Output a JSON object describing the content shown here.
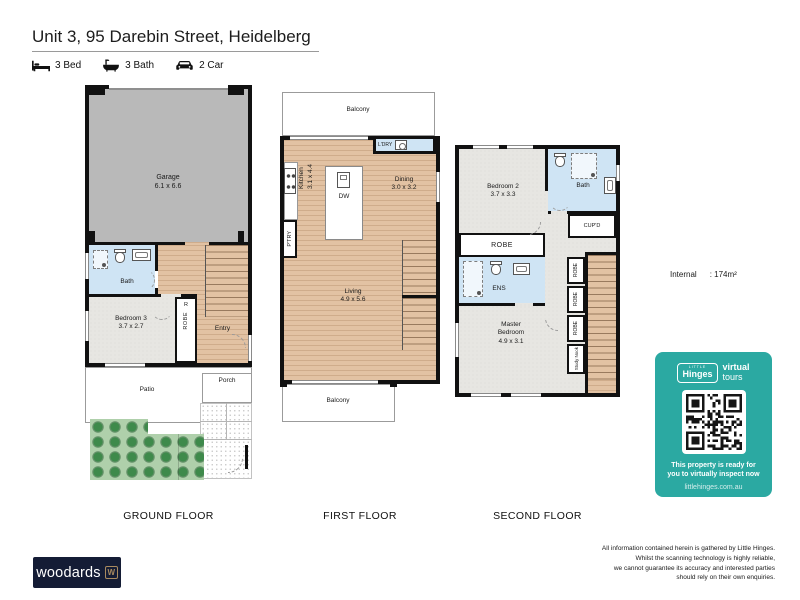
{
  "header": {
    "title": "Unit 3, 95 Darebin Street, Heidelberg",
    "features": [
      {
        "icon": "bed-icon",
        "label": "3 Bed"
      },
      {
        "icon": "bath-icon",
        "label": "3 Bath"
      },
      {
        "icon": "car-icon",
        "label": "2 Car"
      }
    ]
  },
  "floors": {
    "ground": {
      "caption": "GROUND FLOOR",
      "garage_name": "Garage",
      "garage_dims": "6.1 x 6.6",
      "bath_label": "Bath",
      "bedroom3_name": "Bedroom 3",
      "bedroom3_dims": "3.7 x 2.7",
      "robe_r": "R",
      "robe": "ROBE",
      "entry": "Entry",
      "patio": "Patio",
      "porch": "Porch"
    },
    "first": {
      "caption": "FIRST FLOOR",
      "balcony_top": "Balcony",
      "laundry": "L'DRY",
      "kitchen_name": "Kitchen",
      "kitchen_dims": "3.1 x 4.4",
      "pantry": "P'TRY",
      "dishwasher": "DW",
      "dining_name": "Dining",
      "dining_dims": "3.0 x 3.2",
      "living_name": "Living",
      "living_dims": "4.9 x 5.6",
      "balcony_bottom": "Balcony"
    },
    "second": {
      "caption": "SECOND FLOOR",
      "bedroom2_name": "Bedroom 2",
      "bedroom2_dims": "3.7 x 3.3",
      "bath_label": "Bath",
      "cupboard": "CUP'D",
      "robe_band": "ROBE",
      "ensuite": "ENS",
      "master_line1": "Master",
      "master_line2": "Bedroom",
      "master_dims": "4.9 x 3.1",
      "robes": [
        "ROBE",
        "ROBE",
        "ROBE"
      ],
      "study_nook": "Study Nook"
    }
  },
  "area": {
    "label": "Internal",
    "value": ": 174m²"
  },
  "virtual_tour_card": {
    "brand_small": "LITTLE",
    "brand_name": "Hinges",
    "brand_word1": "virtual",
    "brand_word2": "tours",
    "message_line1": "This property is ready for",
    "message_line2": "you to virtually inspect now",
    "website": "littlehinges.com.au"
  },
  "footer": {
    "brand": "woodards",
    "brand_mark": "W",
    "disclaimer": [
      "All information contained herein is gathered by Little Hinges.",
      "Whilst the scanning technology is highly reliable,",
      "we cannot guarantee its accuracy and interested parties",
      "should rely on their own enquiries."
    ]
  },
  "colors": {
    "teal": "#2BA9A2",
    "navy": "#141C35",
    "wall": "#111111",
    "wood": "#E2C2A3",
    "carpet": "#E7E6E2",
    "garage": "#B9B9B9",
    "bathroom": "#CFE4F4",
    "garden": "#AFD0AB",
    "tree": "#3E8A4B",
    "bronze": "#A98A5F"
  }
}
